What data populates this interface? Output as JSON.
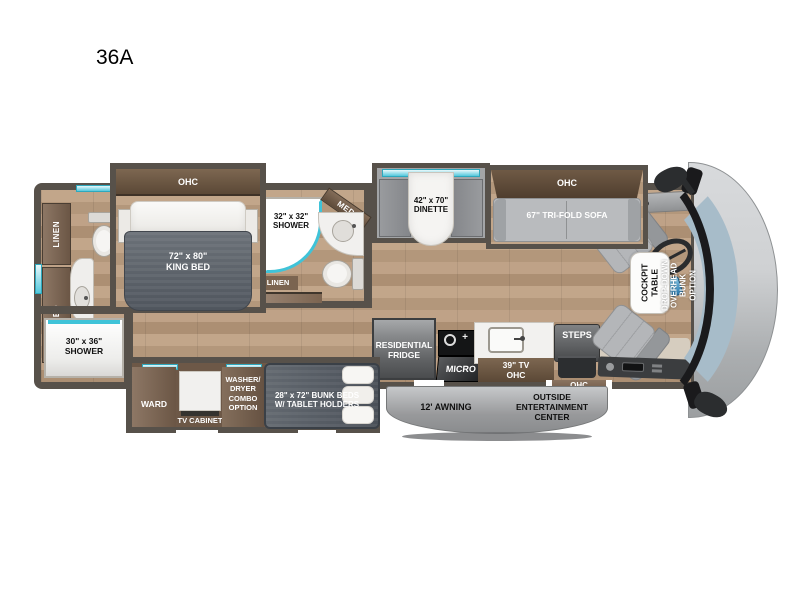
{
  "title": "36A",
  "labels": {
    "bed_ohc": "OHC",
    "king_bed": "72\" x 80\"\nKING BED",
    "rear_linen": "LINEN",
    "rear_med": "MED",
    "rear_shower": "30\" x 36\"\nSHOWER",
    "mid_shower": "32\" x 32\"\nSHOWER",
    "mid_med": "MED",
    "mid_linen": "LINEN",
    "dinette": "42\" x 70\"\nDINETTE",
    "sofa_ohc": "OHC",
    "sofa": "67\" TRI-FOLD SOFA",
    "fridge": "RESIDENTIAL\nFRIDGE",
    "micro": "MICRO",
    "tv_ohc": "39\" TV\nOHC",
    "steps": "STEPS",
    "door_ohc": "OHC",
    "ward": "WARD",
    "tv_cabinet": "TV CABINET",
    "washer_dryer": "WASHER/\nDRYER\nCOMBO\nOPTION",
    "bunk_beds": "28\" x 72\" BUNK BEDS\nW/ TABLET HOLDERS",
    "awning": "12' AWNING",
    "outside_entertainment": "OUTSIDE\nENTERTAINMENT\nCENTER",
    "cockpit_table": "COCKPIT\nTABLE",
    "overhead_bunk": "DROP-DOWN\nOVERHEAD BUNK\nOPTION"
  },
  "colors": {
    "wall": "#57514a",
    "floor": "#b89b7e",
    "cabinet_wood": "#7b6450",
    "window_accent": "#3fc3d8",
    "bed_gray": "#565c64",
    "sofa_gray": "#b7b9bc",
    "windshield": "#a7bcc9",
    "awning_gray": "#9a9c9e"
  }
}
